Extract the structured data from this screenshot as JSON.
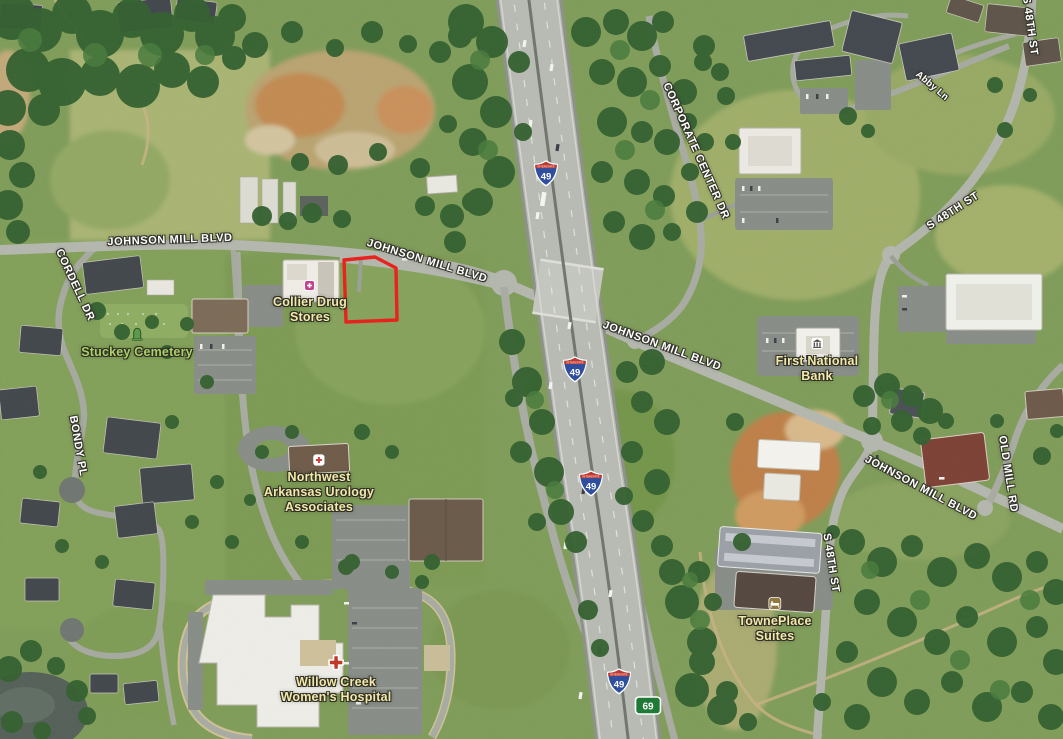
{
  "map": {
    "view": "satellite-aerial",
    "road_names": {
      "johnson_mill_blvd": "JOHNSON MILL BLVD",
      "cordell_dr": "CORDELL DR",
      "bondy_pl": "BONDY PL",
      "corporate_center_dr": "CORPORATE CENTER DR",
      "s_48th_st": "S 48TH ST",
      "old_mill_rd": "OLD MILL RD",
      "abby_ln": "Abby Ln"
    },
    "places": {
      "collier_drug": {
        "name_lines": [
          "Collier Drug",
          "Stores"
        ],
        "icon": "pharmacy"
      },
      "stuckey_cemetery": {
        "name_lines": [
          "Stuckey Cemetery"
        ],
        "icon": "cemetery"
      },
      "nw_urology": {
        "name_lines": [
          "Northwest",
          "Arkansas Urology",
          "Associates"
        ],
        "icon": "medical"
      },
      "first_national_bank": {
        "name_lines": [
          "First National",
          "Bank"
        ],
        "icon": "bank"
      },
      "towneplace_suites": {
        "name_lines": [
          "TownePlace",
          "Suites"
        ],
        "icon": "lodging"
      },
      "willow_creek_hospital": {
        "name_lines": [
          "Willow Creek",
          "Women's Hospital"
        ],
        "icon": "hospital-cross"
      }
    },
    "shields": {
      "interstate": {
        "banner": "INTERSTATE",
        "number": "49"
      },
      "route_69": {
        "number": "69"
      }
    },
    "colors": {
      "parcel_outline": "#e8231d",
      "road_label": "#ffffff",
      "poi_label": "#f3e9a9",
      "cemetery_label": "#abd164",
      "interstate_blue": "#2f4e9e",
      "interstate_red": "#c0392e",
      "route_green": "#1f7a37"
    }
  }
}
